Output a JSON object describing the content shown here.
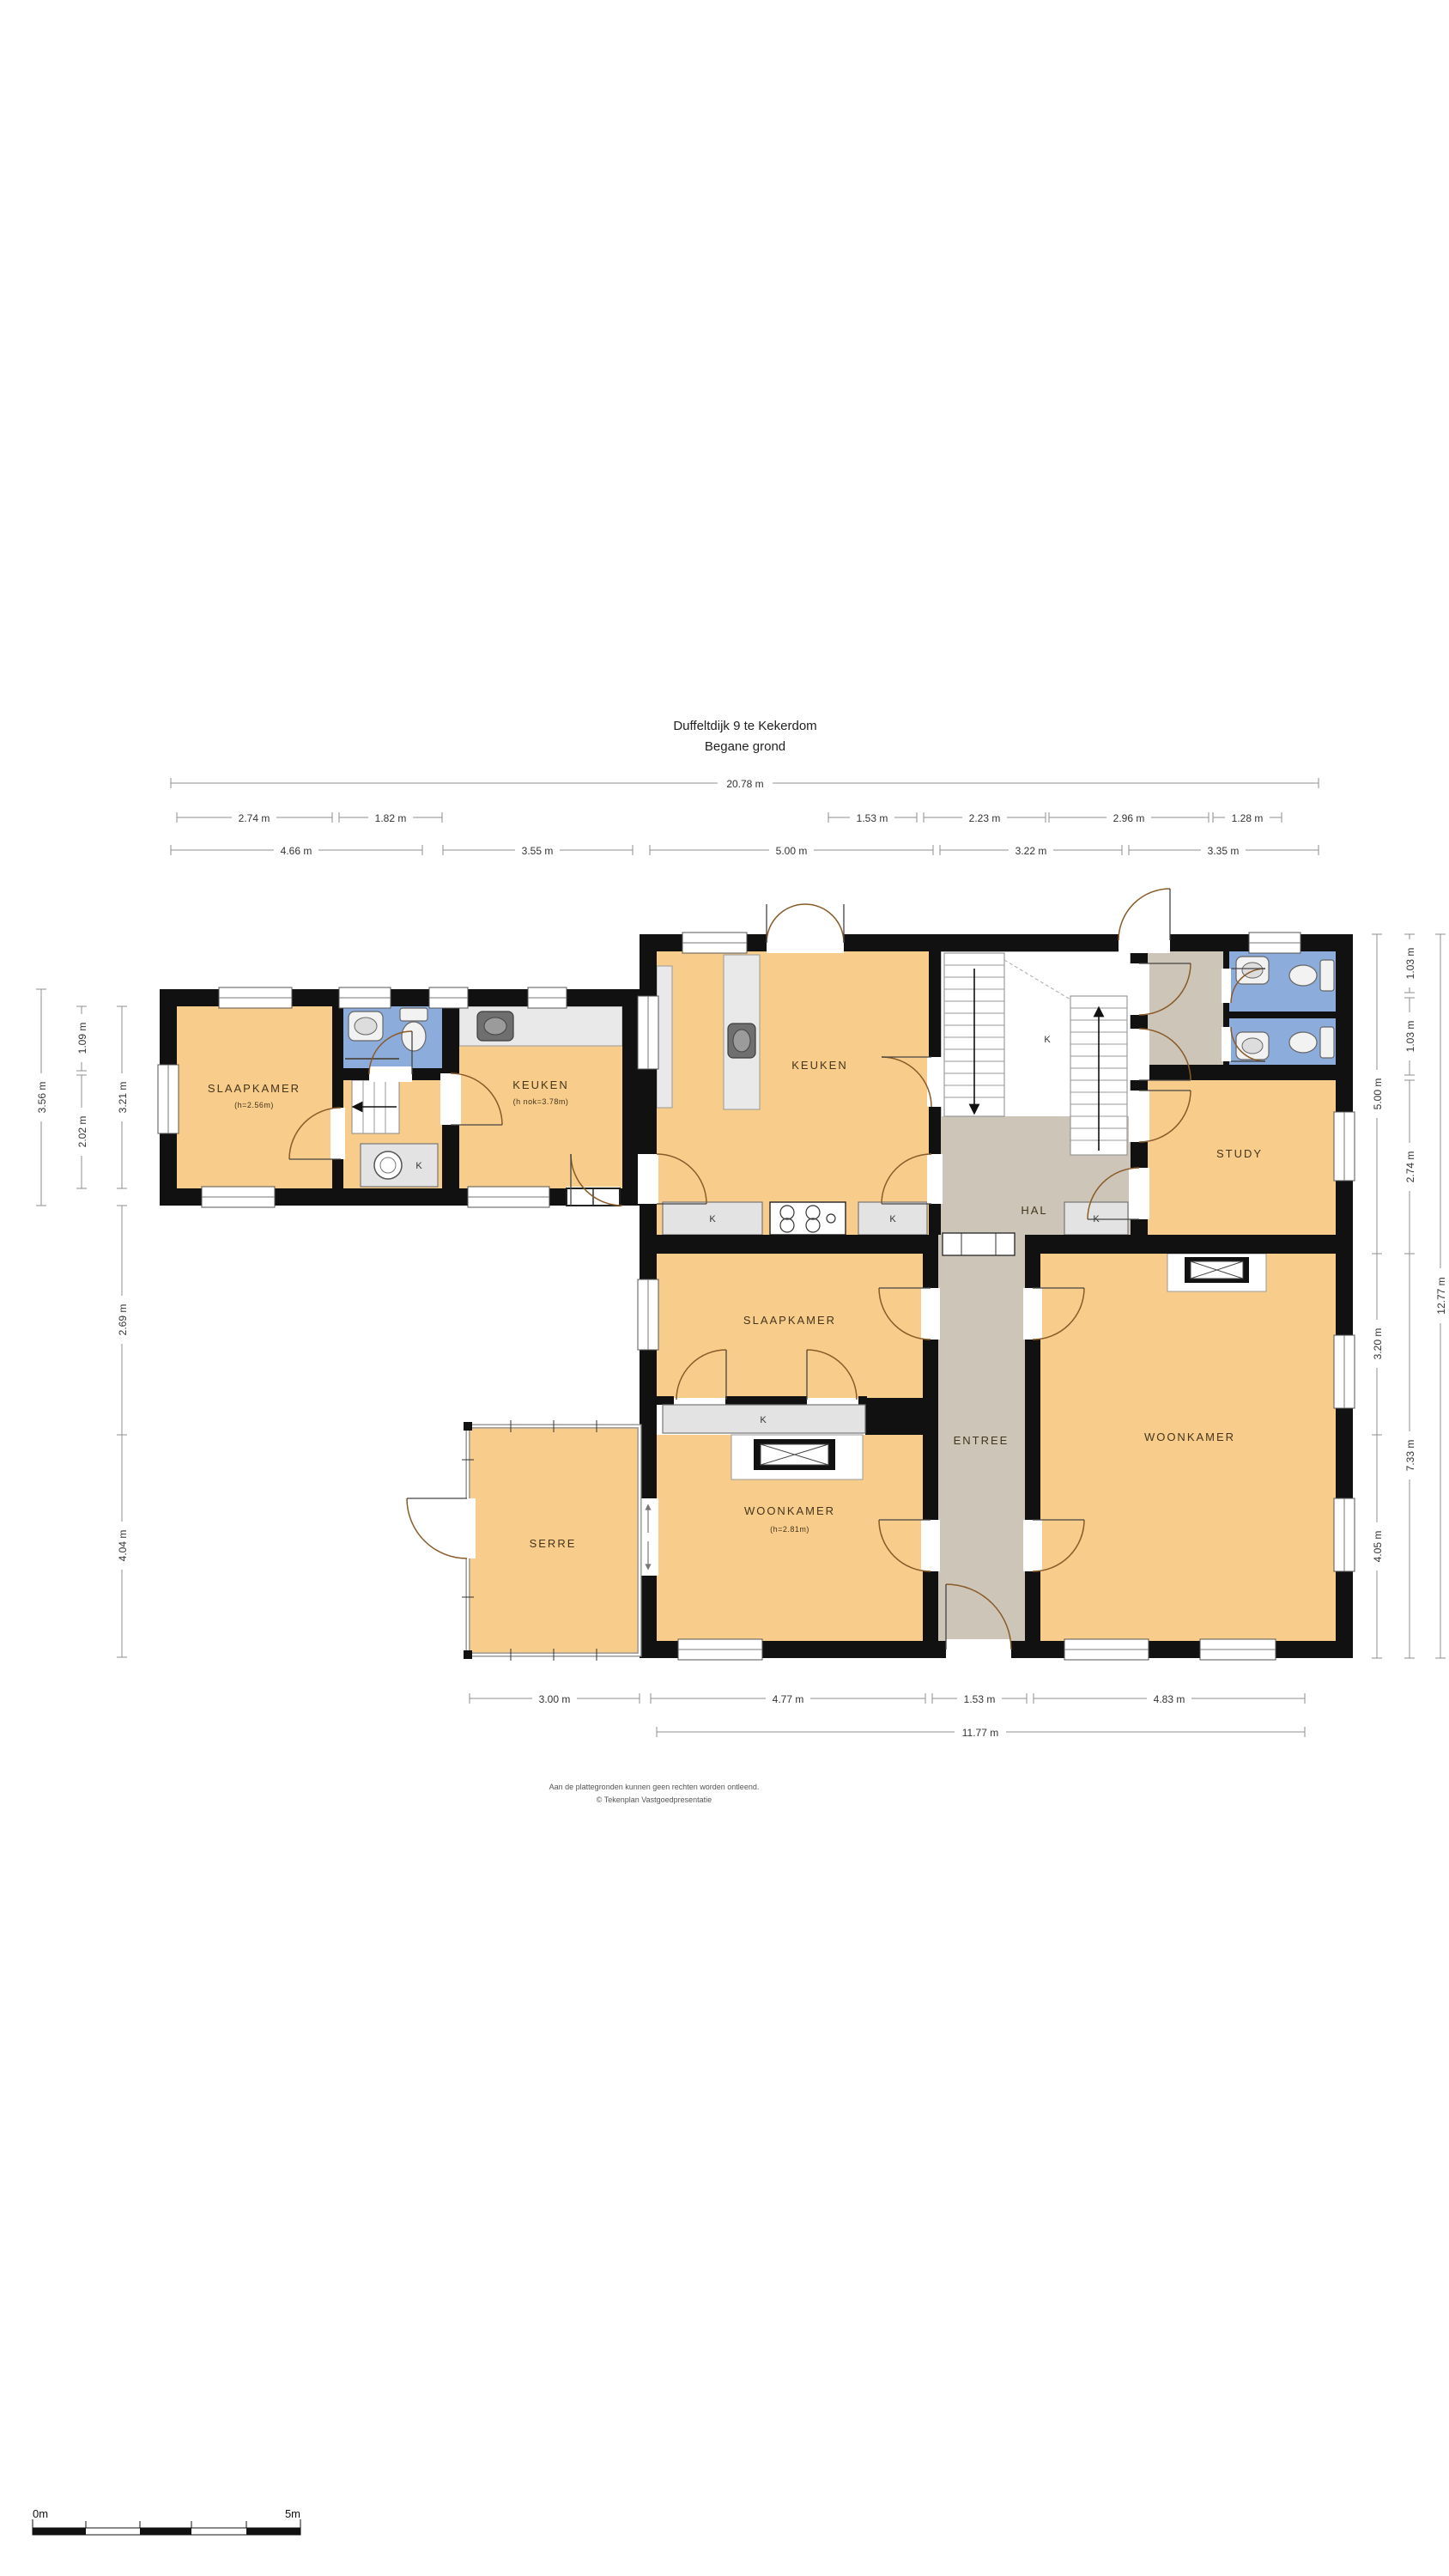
{
  "title": {
    "line1": "Duffeltdijk 9 te Kekerdom",
    "line2": "Begane grond"
  },
  "rooms": {
    "slaapkamer_west": {
      "name": "SLAAPKAMER",
      "sub": "(h=2.56m)"
    },
    "keuken_west": {
      "name": "KEUKEN",
      "sub": "(h nok=3.78m)"
    },
    "keuken": {
      "name": "KEUKEN"
    },
    "hal": {
      "name": "HAL"
    },
    "study": {
      "name": "STUDY"
    },
    "slaapkamer": {
      "name": "SLAAPKAMER"
    },
    "entree": {
      "name": "ENTREE"
    },
    "woonkamer_left": {
      "name": "WOONKAMER",
      "sub": "(h=2.81m)"
    },
    "woonkamer_right": {
      "name": "WOONKAMER"
    },
    "serre": {
      "name": "SERRE"
    },
    "closet_label": "K"
  },
  "dimensions": {
    "top_overall": "20.78 m",
    "top_row2": [
      "2.74 m",
      "1.82 m",
      "1.53 m",
      "2.23 m",
      "2.96 m",
      "1.28 m"
    ],
    "top_row3": [
      "4.66 m",
      "3.55 m",
      "5.00 m",
      "3.22 m",
      "3.35 m"
    ],
    "left_outer": "3.56 m",
    "left_mid": [
      "1.09 m",
      "2.02 m"
    ],
    "left_inner": [
      "3.21 m",
      "2.69 m",
      "4.04 m"
    ],
    "right_inner": [
      "5.00 m",
      "3.20 m",
      "4.05 m"
    ],
    "right_mid": [
      "1.03 m",
      "1.03 m",
      "2.74 m",
      "7.33 m"
    ],
    "right_overall": "12.77 m",
    "bottom_row1": [
      "3.00 m",
      "4.77 m",
      "1.53 m",
      "4.83 m"
    ],
    "bottom_overall": "11.77 m"
  },
  "footer": {
    "line1": "Aan de plattegronden kunnen geen rechten worden ontleend.",
    "line2": "© Tekenplan Vastgoedpresentatie"
  },
  "scale_bar": {
    "start": "0m",
    "end": "5m"
  },
  "colors": {
    "floor": "#F8CD8C",
    "hall": "#CDC5B8",
    "bath": "#8CACDC",
    "wall": "#111111",
    "counter": "#E9E9E9"
  }
}
